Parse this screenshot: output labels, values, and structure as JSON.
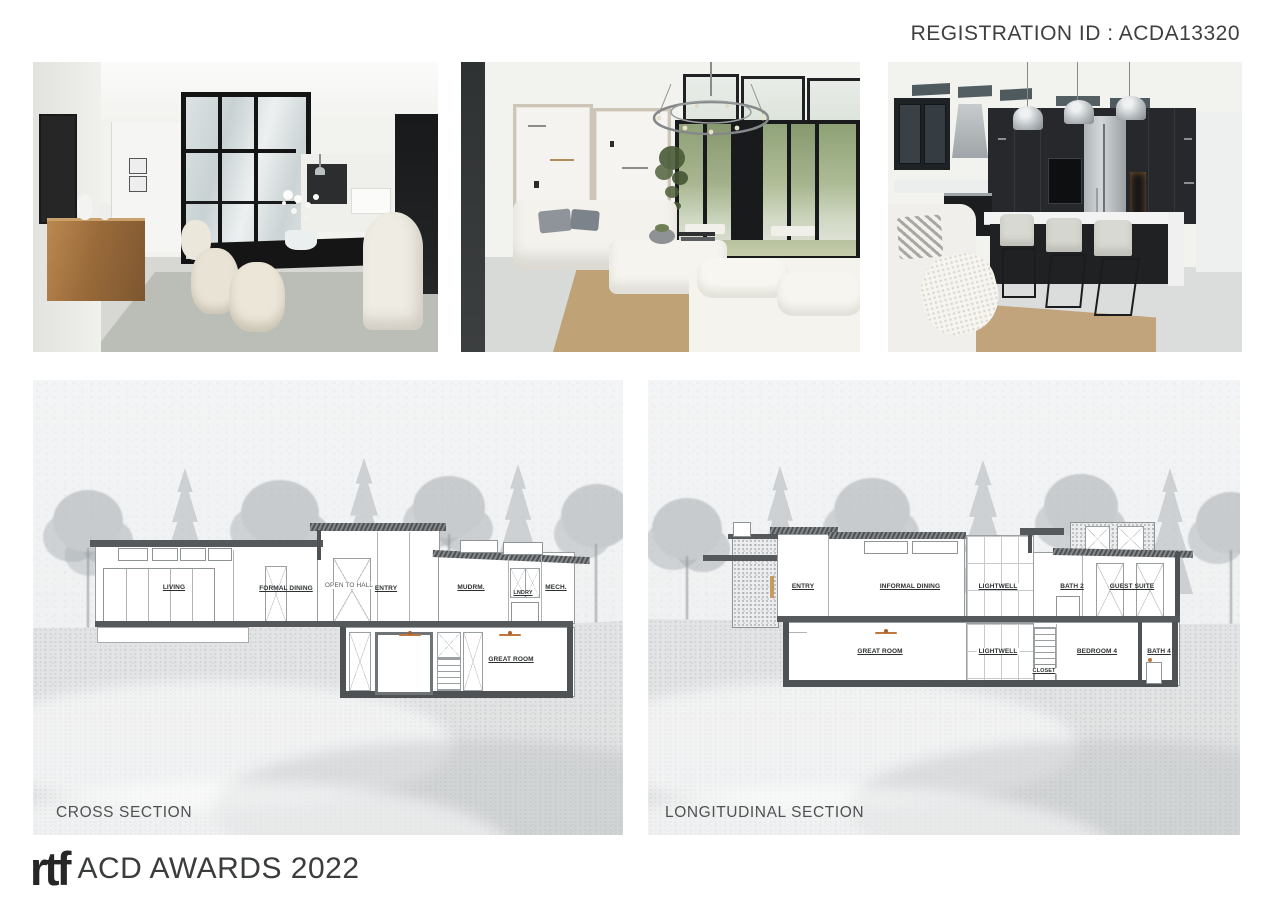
{
  "header": {
    "registration_id": "REGISTRATION ID : ACDA13320"
  },
  "sections": {
    "cross": {
      "caption": "CROSS SECTION",
      "labels": {
        "upper": [
          "LIVING",
          "FORMAL DINING",
          "OPEN TO HALL",
          "ENTRY",
          "MUDRM.",
          "LNDRY",
          "MECH."
        ],
        "lower": [
          "GREAT ROOM"
        ]
      }
    },
    "longitudinal": {
      "caption": "LONGITUDINAL SECTION",
      "labels": {
        "upper": [
          "ENTRY",
          "INFORMAL DINING",
          "LIGHTWELL",
          "BATH 2",
          "GUEST SUITE"
        ],
        "lower": [
          "GREAT ROOM",
          "LIGHTWELL",
          "CLOSET",
          "BEDROOM 4",
          "BATH 4"
        ]
      }
    }
  },
  "footer": {
    "logo_mark": "rtf",
    "awards_text": "ACD AWARDS 2022"
  },
  "colors": {
    "accent_fan": "#c0773c",
    "drawing_line": "#979c9e",
    "poche": "#4e5254"
  }
}
